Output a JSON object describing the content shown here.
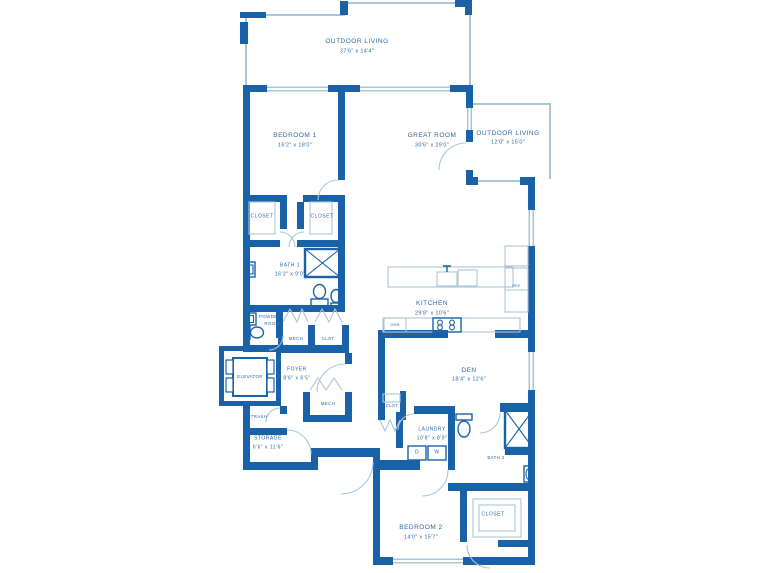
{
  "plan": {
    "type": "residential condominium floor plan",
    "colors": {
      "wall": "#1a62a7",
      "line": "#a9c5da",
      "text": "#2f679f",
      "background": "#ffffff"
    },
    "rooms": [
      {
        "id": "outdoor-living-top",
        "name": "OUTDOOR LIVING",
        "dims": "37'6\" x 14'4\""
      },
      {
        "id": "bedroom-1",
        "name": "BEDROOM 1",
        "dims": "16'2\" x 18'0\""
      },
      {
        "id": "great-room",
        "name": "GREAT ROOM",
        "dims": "30'6\" x 29'0\""
      },
      {
        "id": "outdoor-living-right",
        "name": "OUTDOOR LIVING",
        "dims": "12'0\" x 15'0\""
      },
      {
        "id": "closet-1",
        "name": "CLOSET",
        "dims": ""
      },
      {
        "id": "closet-2",
        "name": "CLOSET",
        "dims": ""
      },
      {
        "id": "bath-1",
        "name": "BATH 1",
        "dims": "16'2\" x 9'0\""
      },
      {
        "id": "powder-room",
        "line1": "POWDER",
        "line2": "ROOM"
      },
      {
        "id": "mech-upper",
        "name": "MECH",
        "dims": ""
      },
      {
        "id": "clst-upper",
        "name": "CLST",
        "dims": ""
      },
      {
        "id": "kitchen",
        "name": "KITCHEN",
        "dims": "29'8\" x 10'6\""
      },
      {
        "id": "foyer",
        "name": "FOYER",
        "dims": "8'6\" x 6'5\""
      },
      {
        "id": "elevator",
        "name": "ELEVATOR",
        "dims": ""
      },
      {
        "id": "mech-lower",
        "name": "MECH",
        "dims": ""
      },
      {
        "id": "clst-den",
        "name": "CLST",
        "dims": ""
      },
      {
        "id": "den",
        "name": "DEN",
        "dims": "18'4\" x 12'6\""
      },
      {
        "id": "trash",
        "name": "TRASH",
        "dims": ""
      },
      {
        "id": "storage",
        "name": "STORAGE",
        "dims": "6'6\" x 11'6\""
      },
      {
        "id": "laundry",
        "name": "LAUNDRY",
        "dims": "10'8\" x 8'9\""
      },
      {
        "id": "bath-2",
        "name": "BATH 2",
        "dims": ""
      },
      {
        "id": "bedroom-2",
        "name": "BEDROOM 2",
        "dims": "14'0\" x 15'7\""
      },
      {
        "id": "closet-bedroom-2",
        "name": "CLOSET",
        "dims": ""
      }
    ],
    "appliances": {
      "oven": "OVN",
      "refrigerator": "REF",
      "dryer": "D",
      "washer": "W"
    }
  }
}
